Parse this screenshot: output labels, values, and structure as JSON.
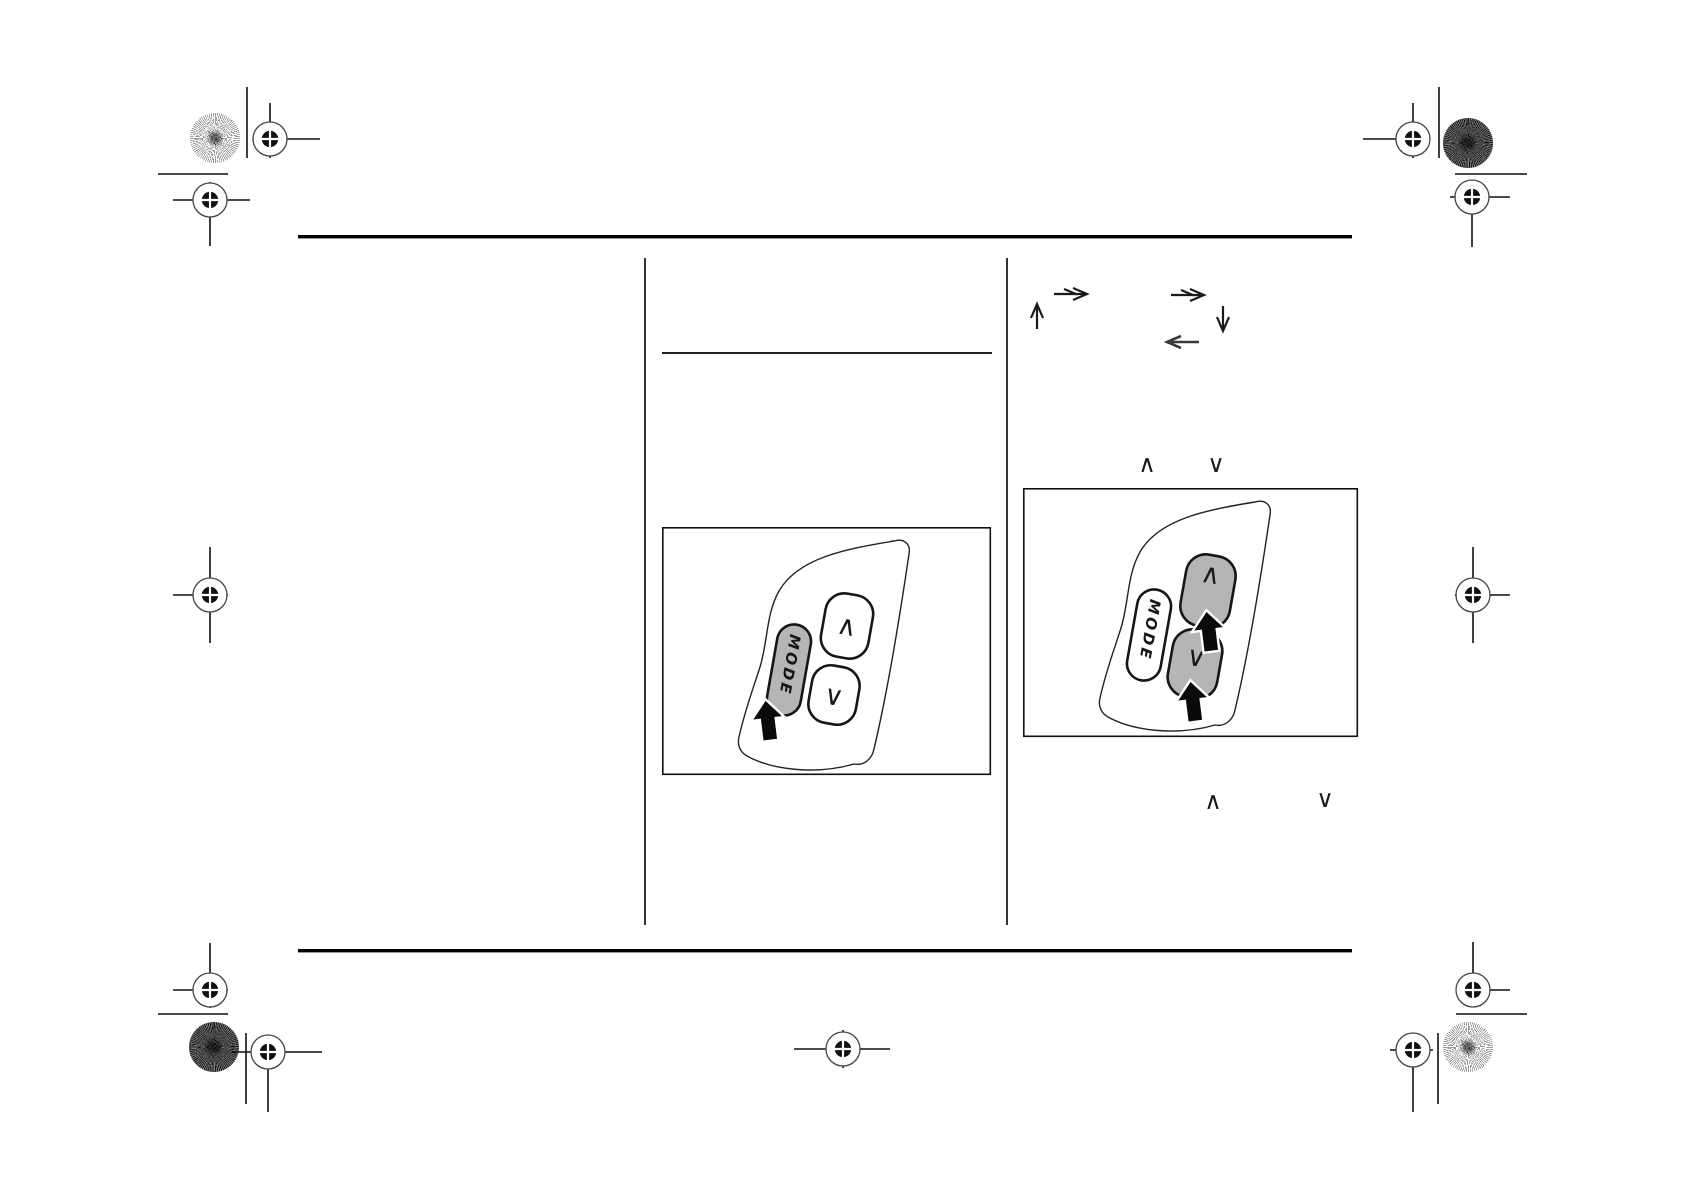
{
  "figures": {
    "mode_figure": {
      "mode_label": "MODE",
      "up_glyph": "∧",
      "down_glyph": "∨"
    },
    "seek_figure": {
      "mode_label": "MODE",
      "up_glyph": "∧",
      "down_glyph": "∨"
    }
  },
  "inline_glyphs": {
    "upper_up": "∧",
    "upper_down": "∨",
    "lower_up": "∧",
    "lower_down": "∨"
  },
  "colors": {
    "button_gray": "#b5b5b5",
    "ink": "#000000"
  }
}
